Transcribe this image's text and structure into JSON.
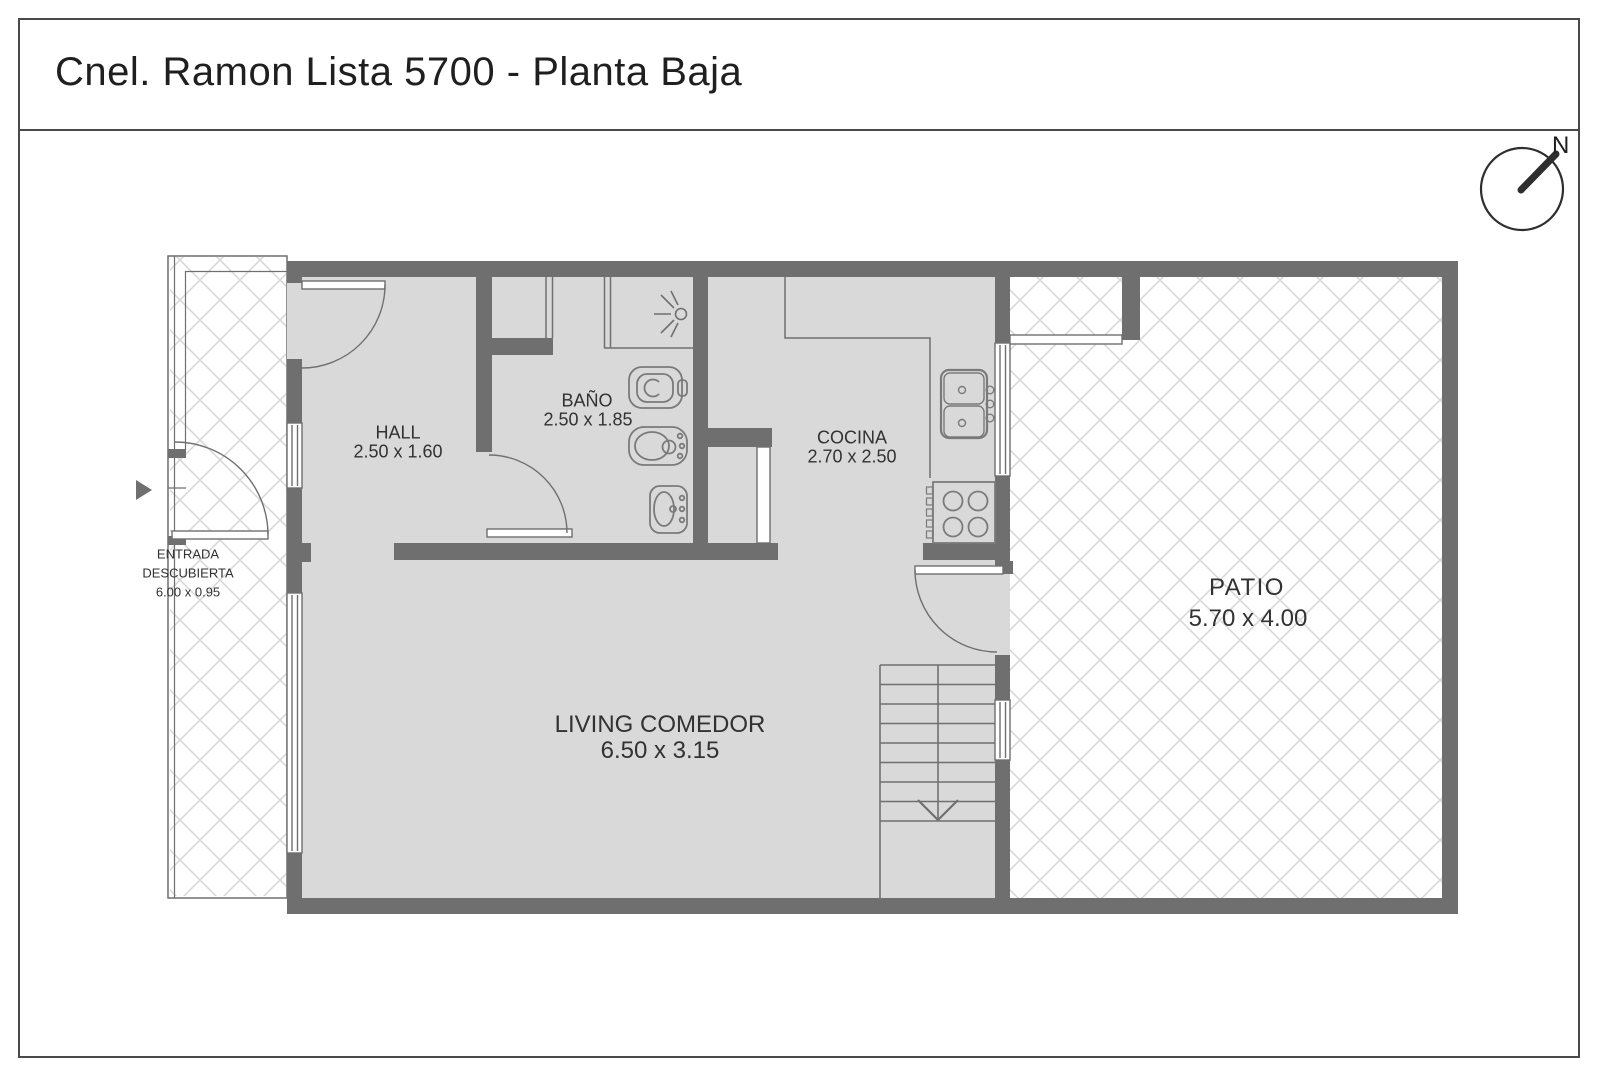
{
  "title": "Cnel. Ramon Lista 5700 - Planta Baja",
  "compass": {
    "north_label": "N"
  },
  "rooms": {
    "hall": {
      "name": "HALL",
      "dims": "2.50 x 1.60"
    },
    "bano": {
      "name": "BAÑO",
      "dims": "2.50 x 1.85"
    },
    "cocina": {
      "name": "COCINA",
      "dims": "2.70 x 2.50"
    },
    "living": {
      "name": "LIVING COMEDOR",
      "dims": "6.50 x 3.15"
    },
    "patio": {
      "name": "PATIO",
      "dims": "5.70 x 4.00"
    },
    "entrada": {
      "name_line1": "ENTRADA",
      "name_line2": "DESCUBIERTA",
      "dims": "6.00 x 0.95"
    }
  },
  "icons": [
    "compass-needle-icon",
    "shower-head-icon",
    "toilet-icon",
    "bidet-icon",
    "washbasin-icon",
    "kitchen-sink-icon",
    "stove-icon",
    "stairs-down-arrow-icon",
    "entrance-arrow-icon"
  ],
  "colors": {
    "background": "#ffffff",
    "border": "#4a4a4a",
    "wall": "#6f6f6f",
    "floor": "#d9d9d9",
    "line": "#707070",
    "hatch": "#d6d6d6",
    "text": "#323232",
    "title_text": "#1f1f1f"
  }
}
